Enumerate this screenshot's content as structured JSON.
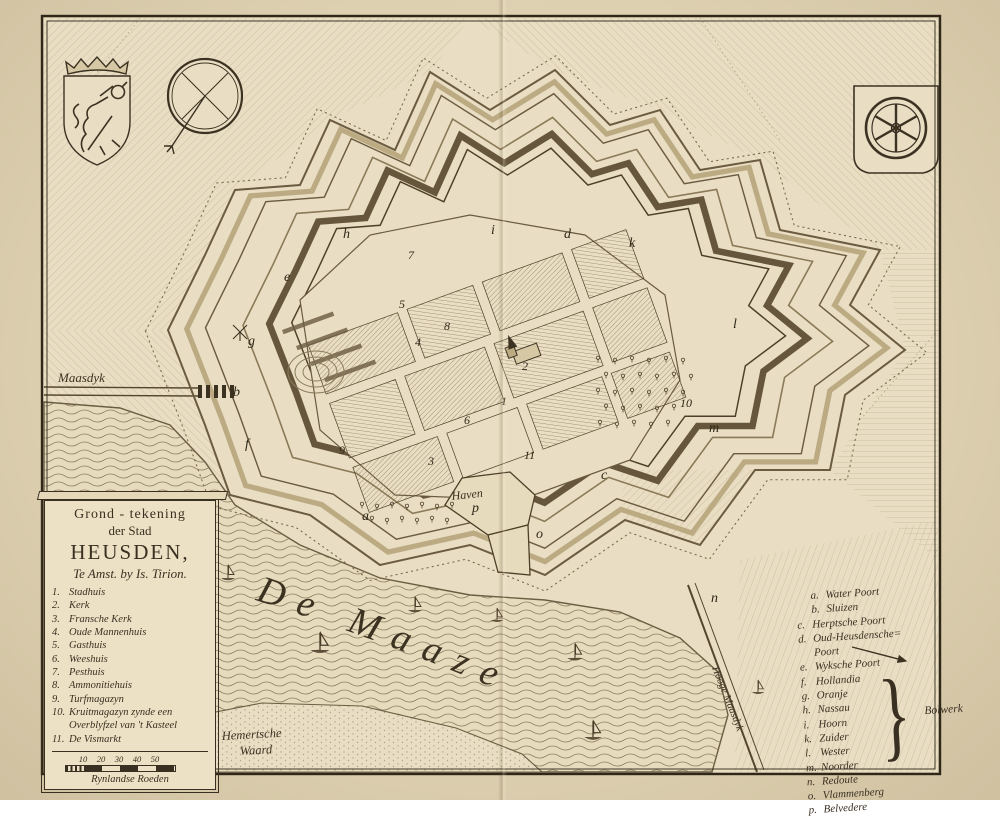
{
  "plate": {
    "cartouche": {
      "title_line1": "Grond - tekening",
      "title_line2": "der Stad",
      "title_line3": "HEUSDEN,",
      "imprint": "Te Amst. by Is. Tirion.",
      "entries": [
        {
          "num": "1.",
          "label": "Stadhuis"
        },
        {
          "num": "2.",
          "label": "Kerk"
        },
        {
          "num": "3.",
          "label": "Fransche Kerk"
        },
        {
          "num": "4.",
          "label": "Oude Mannenhuis"
        },
        {
          "num": "5.",
          "label": "Gasthuis"
        },
        {
          "num": "6.",
          "label": "Weeshuis"
        },
        {
          "num": "7.",
          "label": "Pesthuis"
        },
        {
          "num": "8.",
          "label": "Ammonitiehuis"
        },
        {
          "num": "9.",
          "label": "Turfmagazyn"
        },
        {
          "num": "10.",
          "label": "Kruitmagazyn zynde een Overblyfzel van 't Kasteel"
        },
        {
          "num": "11.",
          "label": "De Vismarkt"
        }
      ],
      "scale_ticks": [
        "10",
        "20",
        "30",
        "40",
        "50"
      ],
      "scale_caption": "Rynlandse Roeden"
    },
    "key": {
      "entries": [
        {
          "key": "a.",
          "label": "Water Poort",
          "indent": true
        },
        {
          "key": "b.",
          "label": "Sluizen",
          "indent": true
        },
        {
          "key": "c.",
          "label": "Herptsche Poort"
        },
        {
          "key": "d.",
          "label": "Oud-Heusdensche=",
          "label2": "Poort"
        },
        {
          "key": "e.",
          "label": "Wyksche Poort"
        },
        {
          "key": "f.",
          "label": "Hollandia",
          "group": true
        },
        {
          "key": "g.",
          "label": "Oranje",
          "group": true
        },
        {
          "key": "h.",
          "label": "Nassau",
          "group": true
        },
        {
          "key": "i.",
          "label": "Hoorn",
          "group": true
        },
        {
          "key": "k.",
          "label": "Zuider",
          "group": true
        },
        {
          "key": "l.",
          "label": "Wester",
          "group": true
        },
        {
          "key": "m.",
          "label": "Noorder",
          "group": true
        },
        {
          "key": "n.",
          "label": "Redoute"
        },
        {
          "key": "o.",
          "label": "Vlammenberg"
        },
        {
          "key": "p.",
          "label": "Belvedere"
        }
      ],
      "bracket_label": "Bolwerk"
    },
    "labels": {
      "river": "De Maaze",
      "maasdyk": "Maasdyk",
      "hooge_maasdyk": "Hooge Maasdyk",
      "haven": "Haven",
      "waard_line1": "Hemertsche",
      "waard_line2": "Waard"
    },
    "markers": {
      "letters": [
        {
          "t": "h",
          "x": 343,
          "y": 238
        },
        {
          "t": "i",
          "x": 491,
          "y": 234
        },
        {
          "t": "d",
          "x": 564,
          "y": 238
        },
        {
          "t": "k",
          "x": 629,
          "y": 247
        },
        {
          "t": "l",
          "x": 733,
          "y": 328
        },
        {
          "t": "m",
          "x": 709,
          "y": 432
        },
        {
          "t": "e",
          "x": 284,
          "y": 281
        },
        {
          "t": "g",
          "x": 248,
          "y": 345
        },
        {
          "t": "b",
          "x": 233,
          "y": 396
        },
        {
          "t": "f",
          "x": 245,
          "y": 448
        },
        {
          "t": "a",
          "x": 362,
          "y": 520
        },
        {
          "t": "o",
          "x": 536,
          "y": 538
        },
        {
          "t": "c",
          "x": 601,
          "y": 479
        },
        {
          "t": "n",
          "x": 711,
          "y": 602
        },
        {
          "t": "p",
          "x": 472,
          "y": 512
        }
      ],
      "numbers": [
        {
          "t": "1",
          "x": 501,
          "y": 405
        },
        {
          "t": "2",
          "x": 522,
          "y": 370
        },
        {
          "t": "3",
          "x": 428,
          "y": 465
        },
        {
          "t": "4",
          "x": 415,
          "y": 346
        },
        {
          "t": "5",
          "x": 399,
          "y": 308
        },
        {
          "t": "6",
          "x": 464,
          "y": 424
        },
        {
          "t": "7",
          "x": 408,
          "y": 259
        },
        {
          "t": "8",
          "x": 444,
          "y": 330
        },
        {
          "t": "9",
          "x": 339,
          "y": 454
        },
        {
          "t": "10",
          "x": 680,
          "y": 407
        },
        {
          "t": "11",
          "x": 524,
          "y": 459
        }
      ]
    },
    "colors": {
      "paper": "#e9dec3",
      "page": "#ddd0b0",
      "ink": "#3c3222",
      "hatch": "#a3926e",
      "water_line": "#7d6f52",
      "rampart": "#66563c"
    }
  }
}
